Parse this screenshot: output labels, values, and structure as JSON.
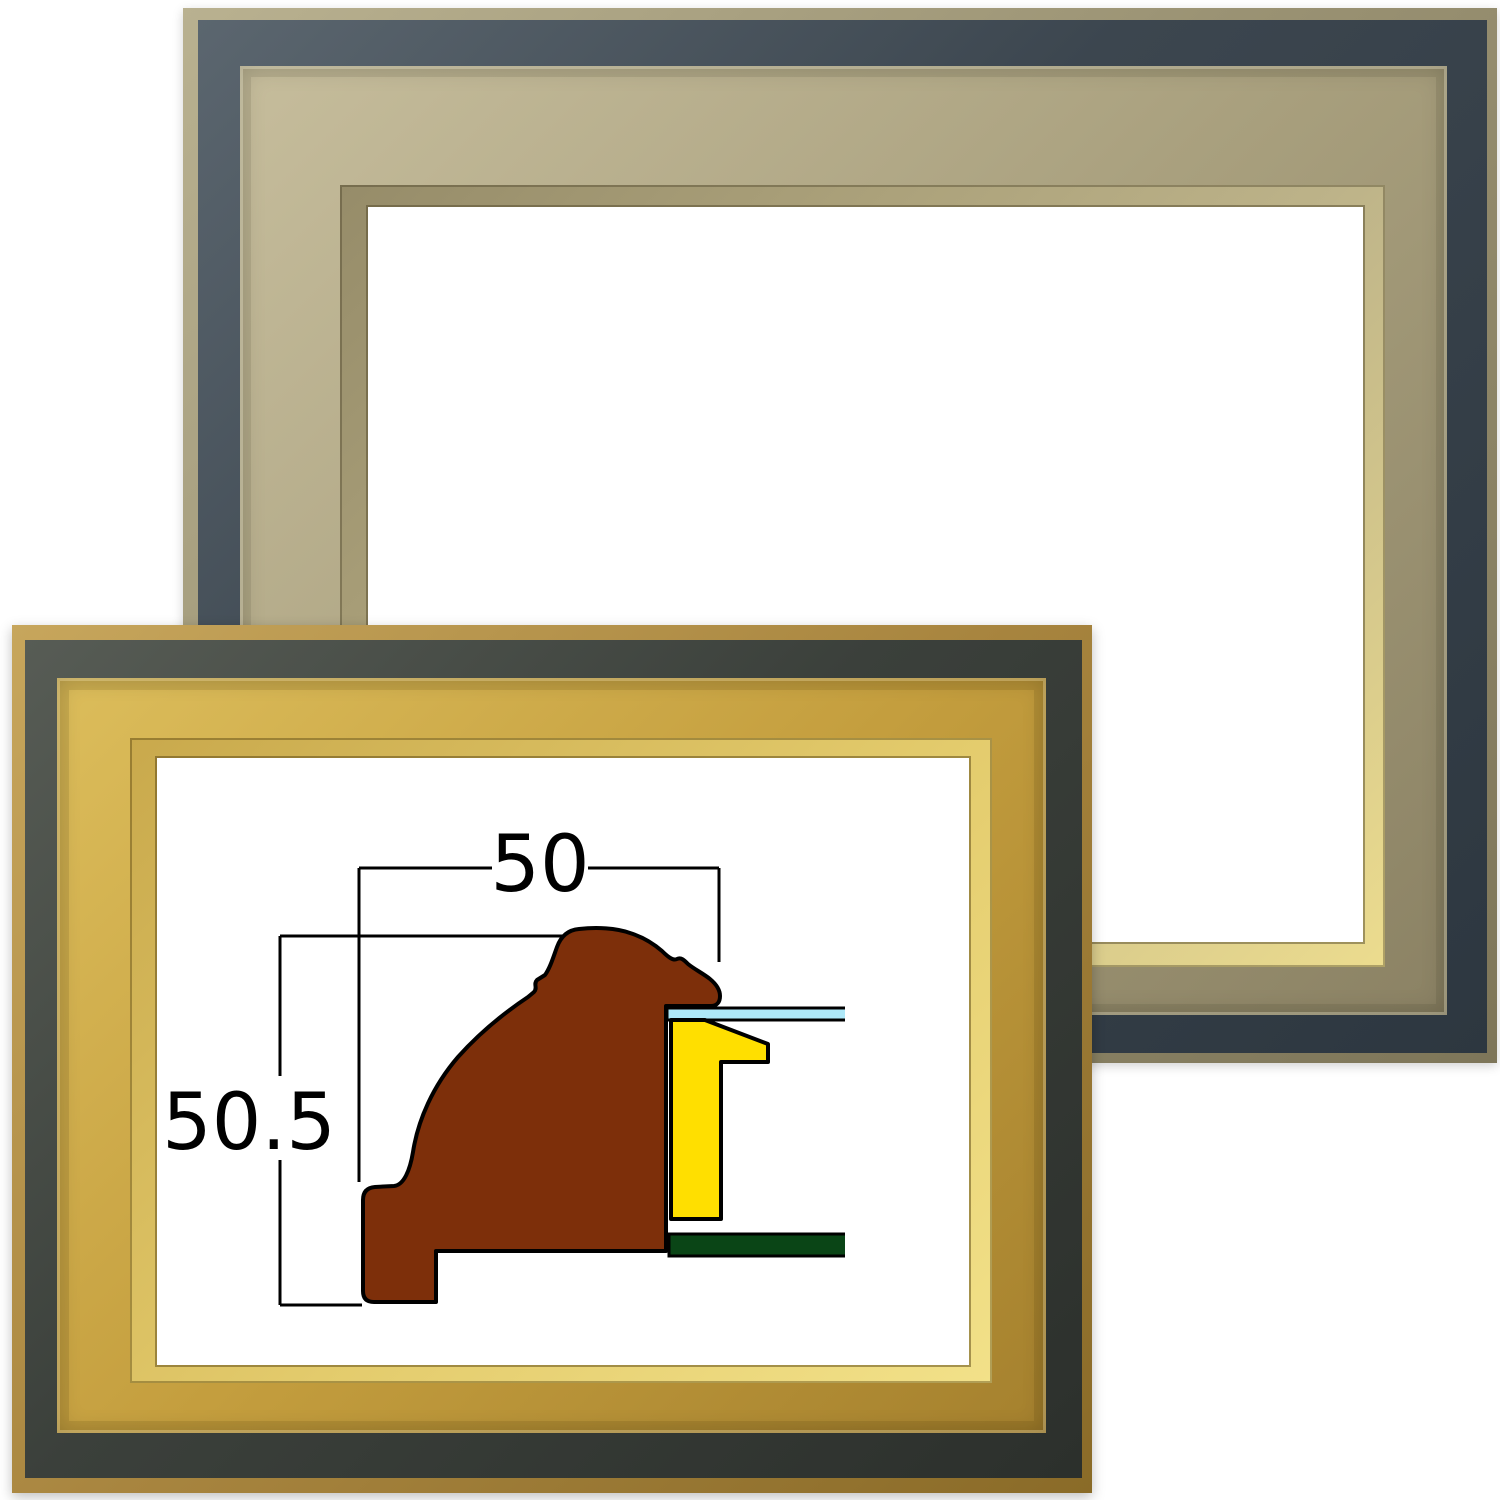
{
  "diagram": {
    "width_label": "50",
    "height_label": "50.5",
    "colors": {
      "profile": "#7d2f0a",
      "liner": "#ffdf00",
      "glass": "#aee8f8",
      "backboard": "#0a4516",
      "line": "#000000"
    }
  },
  "frames": {
    "back": {
      "colors": {
        "outer_edge": "#9a9273",
        "band": "#3c464f",
        "molding": "#a89f7d",
        "inner_lip": "#ecdc8e"
      }
    },
    "front": {
      "colors": {
        "outer_edge": "#a8853f",
        "band": "#3b403b",
        "molding": "#c49e3e",
        "inner_lip": "#f2e189"
      }
    }
  }
}
